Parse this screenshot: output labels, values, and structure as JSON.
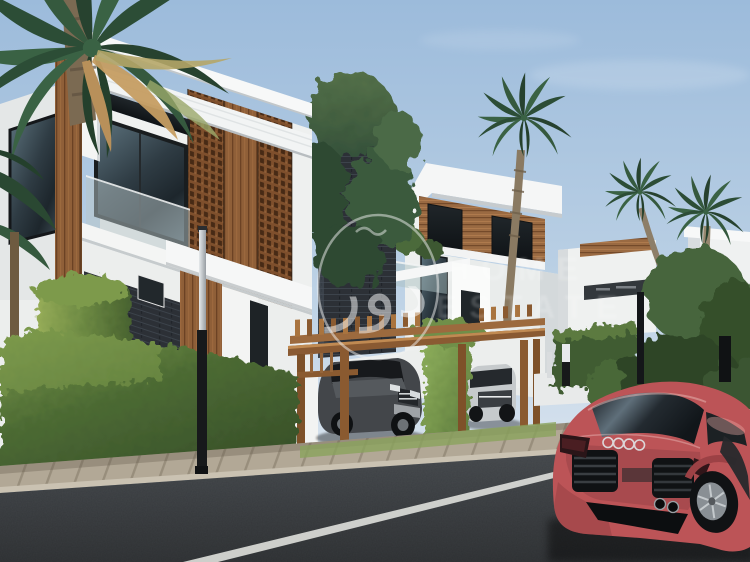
{
  "image": {
    "kind": "3d-architectural-rendering",
    "subject": "modern villas street scene with palms and red sports car"
  },
  "watermark": {
    "logo_text": "دور",
    "line1": "HOME",
    "line2": "ESTATE"
  },
  "palette": {
    "sky_top": "#9cbbdb",
    "sky_horizon": "#dbe5ef",
    "wall_white": "#f2f3f2",
    "wood": "#8f5f38",
    "mashrabiya": "#7e4f2c",
    "slate": "#2c3036",
    "glass": "#31404a",
    "hedge": "#55743c",
    "hedge_light": "#7d9a4c",
    "palm": "#2f5238",
    "pergola": "#9c6a3e",
    "sidewalk": "#b4aa99",
    "road": "#44484c",
    "road_line": "#dfe0dc",
    "car_red": "#bc5457",
    "suv_dark": "#43464a",
    "suv_silver": "#c6cacc",
    "watermark_white": "#f2f2f2"
  }
}
